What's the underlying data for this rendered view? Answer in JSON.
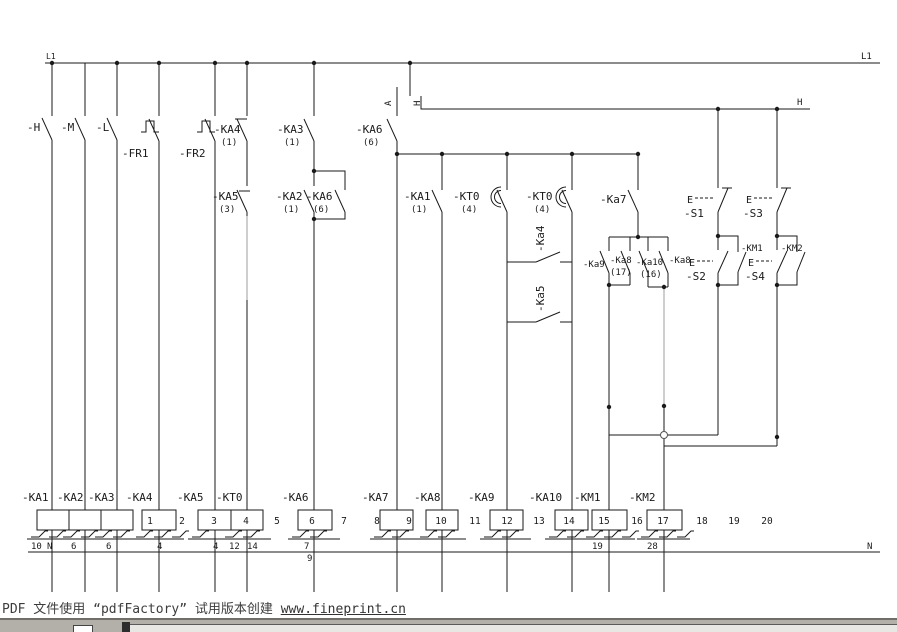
{
  "bus": {
    "l1_left": "L1",
    "l1_right": "L1",
    "h": "H",
    "n_left": "N",
    "n_right": "N",
    "wire_a": "A",
    "wire_h": "H"
  },
  "row1": {
    "h": "-H",
    "m": "-M",
    "l": "-L",
    "fr1": "-FR1",
    "fr2": "-FR2",
    "ka4": "-KA4",
    "ka4_ref": "(1)",
    "ka3": "-KA3",
    "ka3_ref": "(1)",
    "ka6": "-KA6",
    "ka6_ref": "(6)"
  },
  "row2": {
    "ka5": "-KA5",
    "ka5_ref": "(3)",
    "ka2": "-KA2",
    "ka2_ref": "(1)",
    "ka6": "-KA6",
    "ka6_ref": "(6)",
    "ka1": "-KA1",
    "ka1_ref": "(1)",
    "kt0a": "-KT0",
    "kt0a_ref": "(4)",
    "kt0b": "-KT0",
    "kt0b_ref": "(4)",
    "ka7": "-Ka7",
    "s1_e": "E",
    "s1": "-S1",
    "s3_e": "E",
    "s3": "-S3"
  },
  "row3": {
    "ka4": "-Ka4",
    "ka5": "-Ka5",
    "ka9": "-Ka9",
    "ka8a": "-Ka8",
    "ka8a_ref": "(17)",
    "ka10": "-Ka10",
    "ka10_ref": "(16)",
    "ka8b": "-Ka8",
    "s2_e": "E",
    "s2": "-S2",
    "s4_e": "E",
    "s4": "-S4",
    "km1": "-KM1",
    "km2": "-KM2"
  },
  "coils": {
    "ka1": "-KA1",
    "ka2": "-KA2",
    "ka3": "-KA3",
    "ka4": "-KA4",
    "ka5": "-KA5",
    "kt0": "-KT0",
    "ka6": "-KA6",
    "ka7": "-KA7",
    "ka8": "-KA8",
    "ka9": "-KA9",
    "ka10": "-KA10",
    "km1": "-KM1",
    "km2": "-KM2"
  },
  "columns": [
    "1",
    "2",
    "3",
    "4",
    "5",
    "6",
    "7",
    "8",
    "9",
    "10",
    "11",
    "12",
    "13",
    "14",
    "15",
    "16",
    "17",
    "18",
    "19",
    "20"
  ],
  "refs": {
    "r10": "10",
    "n": "N",
    "r6a": "6",
    "r6b": "6",
    "r4a": "4",
    "r4b": "4",
    "r12": "12",
    "r14": "14",
    "r7": "7",
    "r9": "9",
    "r19": "19",
    "r28": "28"
  },
  "watermark": {
    "prefix": "PDF 文件使用 “pdfFactory” 试用版本创建 ",
    "link": "www.fineprint.cn"
  },
  "colors": {
    "line": "#1a1a1a",
    "gray_line": "#9c9c9c",
    "watermark_text": "#3d3d3d",
    "taskbar": "#b3b0aa",
    "taskbar_edge": "#716e69",
    "background": "#ffffff"
  }
}
